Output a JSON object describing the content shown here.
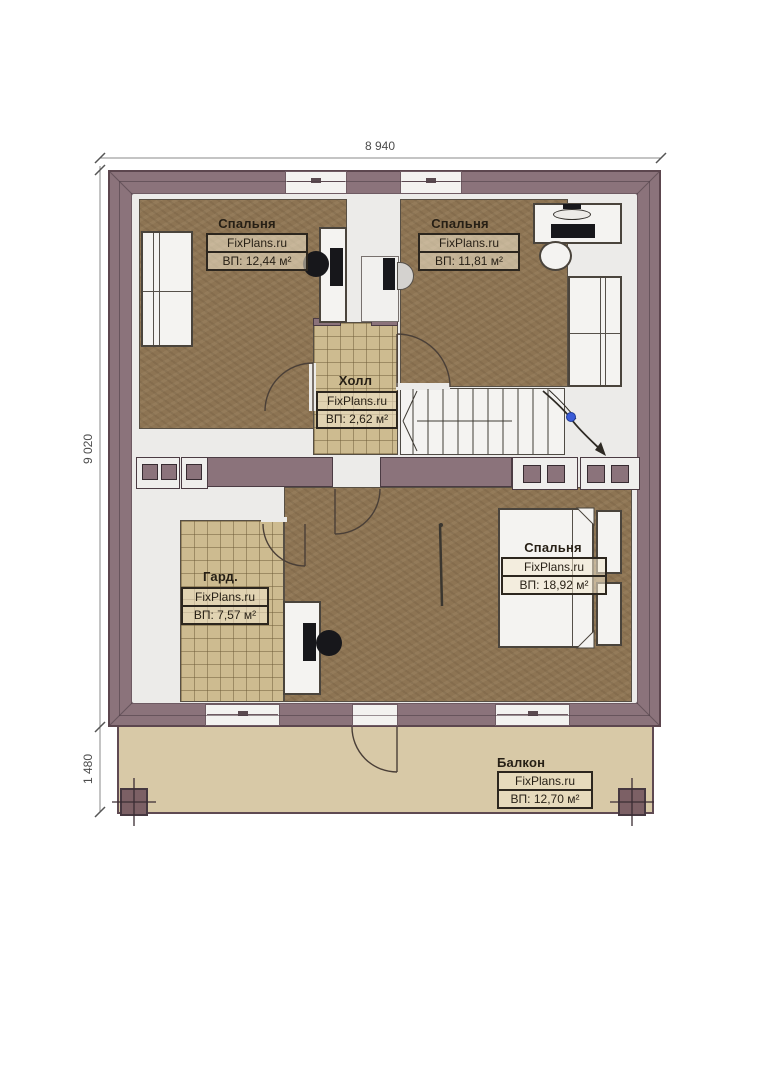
{
  "dimensions": {
    "top": "8 940",
    "left": "9 020",
    "balcony_depth": "1 480"
  },
  "rooms": [
    {
      "id": "bedroom-top-left",
      "name": "Спальня",
      "brand": "FixPlans.ru",
      "area": "ВП: 12,44 м²"
    },
    {
      "id": "bedroom-top-right",
      "name": "Спальня",
      "brand": "FixPlans.ru",
      "area": "ВП: 11,81 м²"
    },
    {
      "id": "hall",
      "name": "Холл",
      "brand": "FixPlans.ru",
      "area": "ВП: 2,62 м²"
    },
    {
      "id": "wardrobe",
      "name": "Гард.",
      "brand": "FixPlans.ru",
      "area": "ВП: 7,57 м²"
    },
    {
      "id": "bedroom-master",
      "name": "Спальня",
      "brand": "FixPlans.ru",
      "area": "ВП: 18,92 м²"
    },
    {
      "id": "balcony",
      "name": "Балкон",
      "brand": "FixPlans.ru",
      "area": "ВП: 12,70 м²"
    }
  ],
  "colors": {
    "wall": "#8b737b",
    "wall_border": "#5c464e",
    "wood_floor": "#8d7453",
    "tile_floor": "#cdbb90",
    "balcony_floor": "#d8c9a7",
    "interior": "#ecebe9",
    "stair_marker_blue": "#3b5bd7"
  }
}
